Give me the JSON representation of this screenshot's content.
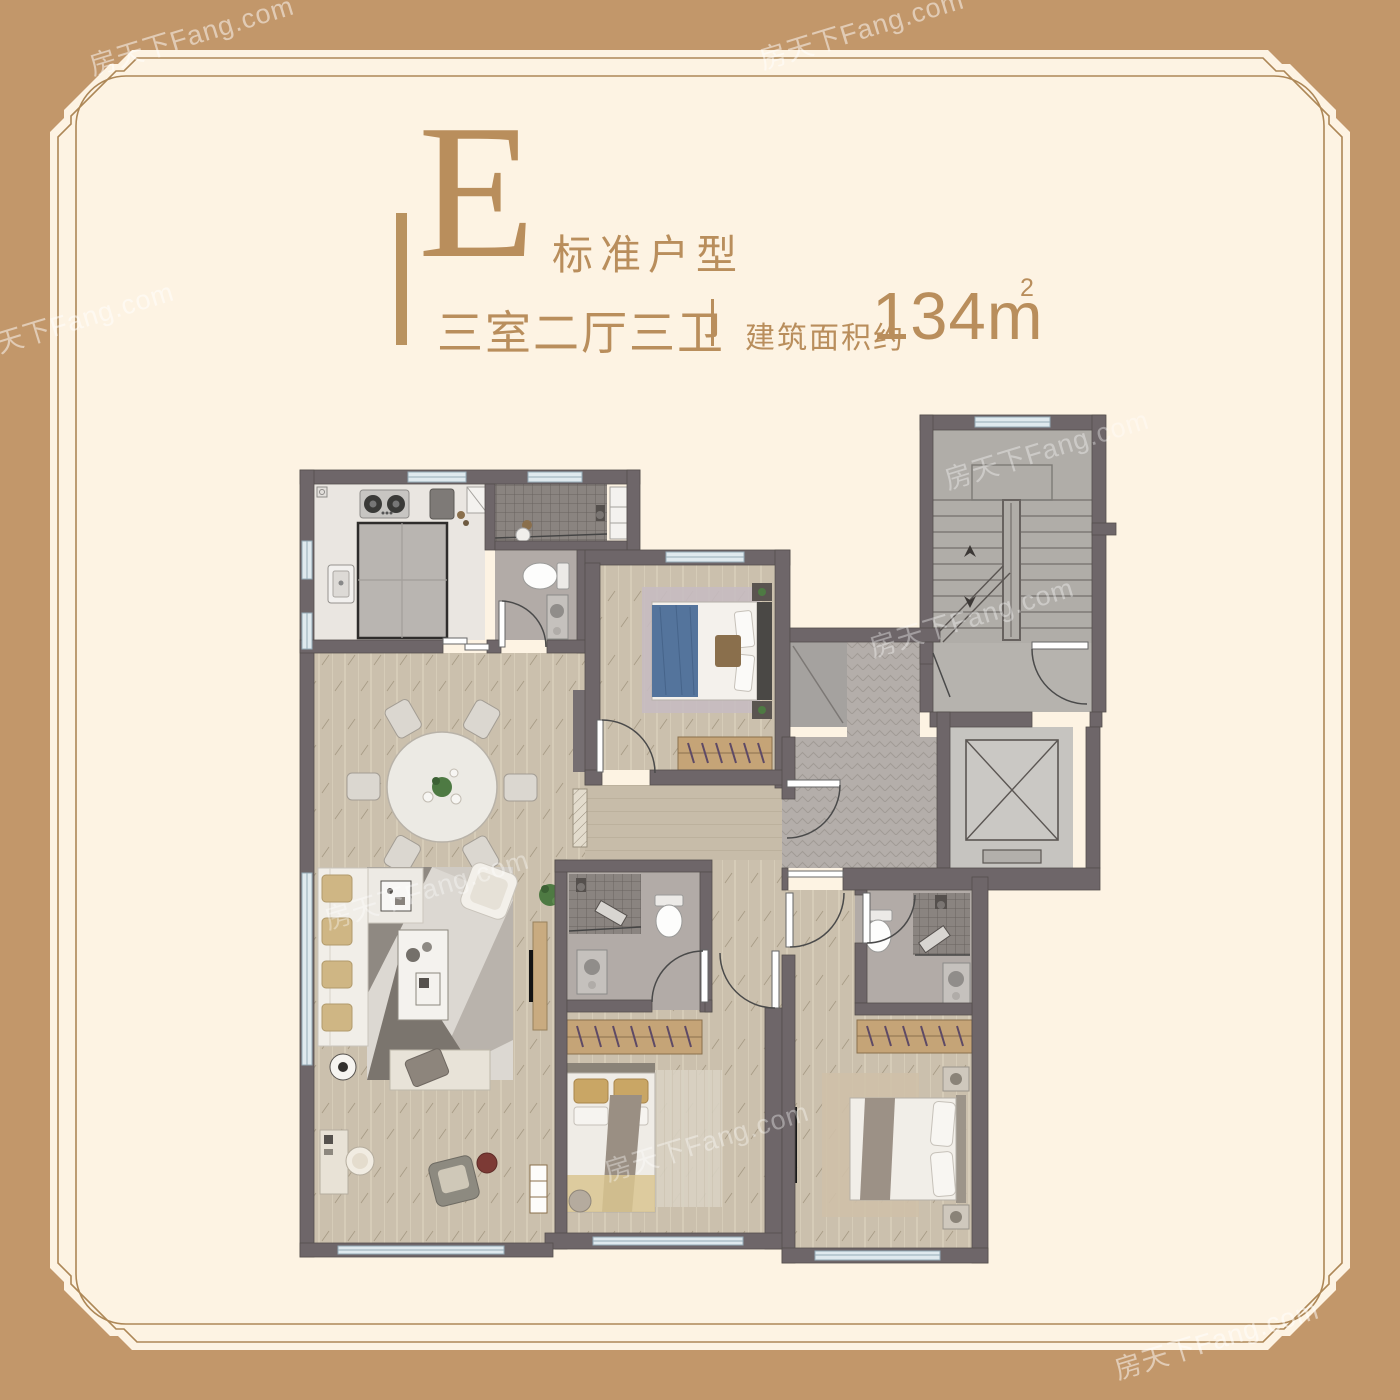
{
  "page": {
    "background": "#c2976a",
    "panel": "#fdf3e3",
    "pinstripe": "#ad8757"
  },
  "title": {
    "unit_letter": "E",
    "unit_type": "标准户型",
    "layout_spec": "三室二厅三卫",
    "area_label": "建筑面积约",
    "area_value": "134m",
    "area_superscript": "2",
    "accent_color": "#b98e5c"
  },
  "watermark": {
    "text": "房天下Fang.com"
  },
  "floor_plan": {
    "wall_color": "#6e6669",
    "wood_floor": "#cbc0ad",
    "tile_floor": "#b2aba7",
    "shower_tile": "#8a8480",
    "stair_floor": "#b0ada8",
    "elevator_floor": "#c6c4c0",
    "window_color": "#dfe9ee",
    "bed_blue": "#54749c",
    "bed_gold": "#c9a665",
    "wardrobe_tan": "#c5a477"
  }
}
